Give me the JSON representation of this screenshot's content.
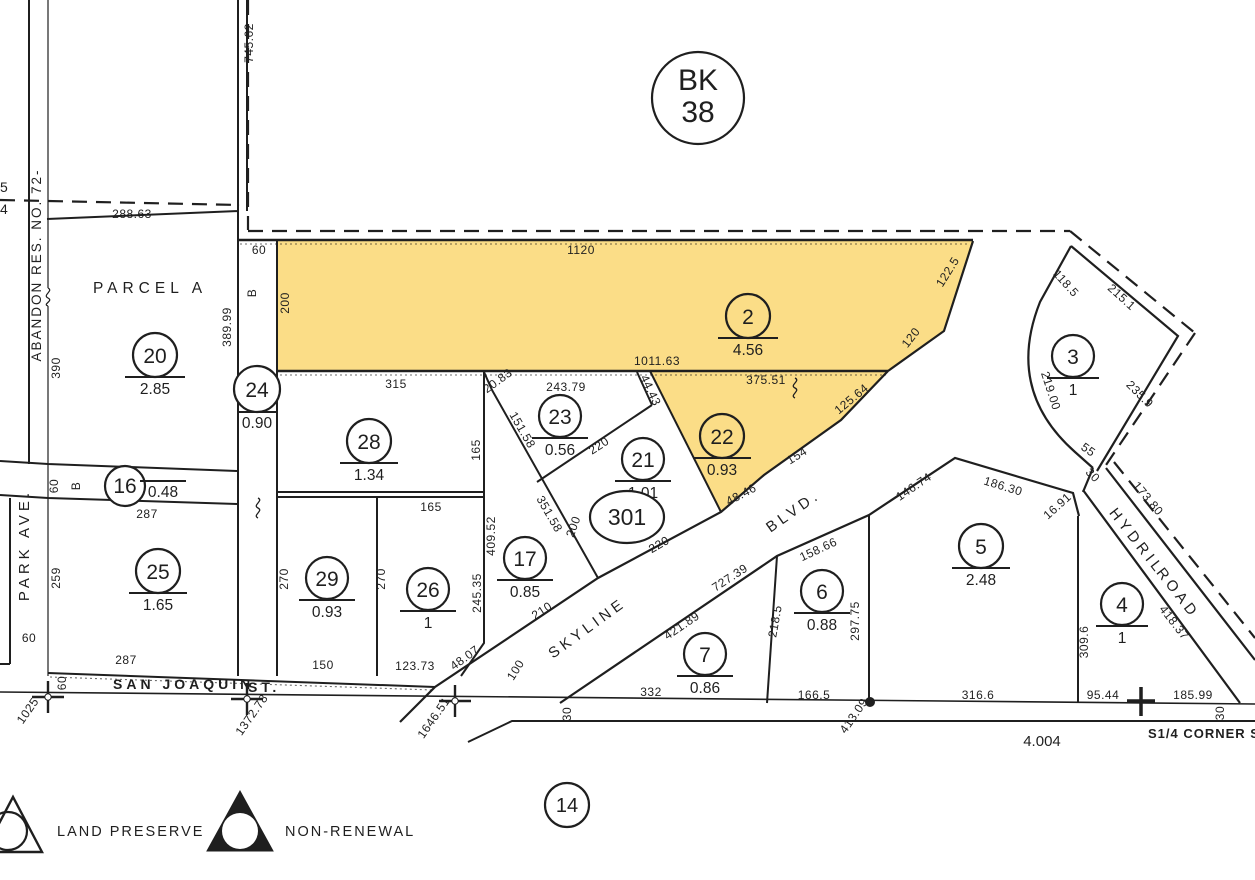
{
  "colors": {
    "highlight": "#FBDD87",
    "ink": "#1f1f1f"
  },
  "badges": {
    "book_line1": "BK",
    "book_line2": "38",
    "sheet": "14"
  },
  "streets": {
    "san_joaquin": "SAN JOAQUIN",
    "san_joaquin_suffix": "ST.",
    "park_ave": "PARK AVE.",
    "skyline": "SKYLINE",
    "skyline_suffix": "BLVD.",
    "hydril": "HYDRIL",
    "hydril_suffix": "ROAD"
  },
  "annotations": {
    "abandon_res": "ABANDON RES. NO. 72-",
    "parcel_a": "PARCEL A",
    "corner_label": "S1/4 CORNER SEC",
    "section_total": "4.004",
    "edge_fragment_top": "5",
    "edge_fragment_bottom": "4"
  },
  "legend": {
    "land_preserve": "LAND PRESERVE",
    "non_renewal": "NON-RENEWAL"
  },
  "parcels": {
    "p20": {
      "num": "20",
      "acres": "2.85"
    },
    "p24": {
      "num": "24",
      "acres": "0.90"
    },
    "p2": {
      "num": "2",
      "acres": "4.56"
    },
    "p3": {
      "num": "3",
      "acres": "1"
    },
    "p16": {
      "num": "16",
      "acres": "0.48"
    },
    "p23": {
      "num": "23",
      "acres": "0.56"
    },
    "p28": {
      "num": "28",
      "acres": "1.34"
    },
    "p21": {
      "num": "21",
      "acres": "1.01"
    },
    "p22": {
      "num": "22",
      "acres": "0.93"
    },
    "p301": {
      "num": "301"
    },
    "p17": {
      "num": "17",
      "acres": "0.85"
    },
    "p29": {
      "num": "29",
      "acres": "0.93"
    },
    "p26": {
      "num": "26",
      "acres": "1"
    },
    "p25": {
      "num": "25",
      "acres": "1.65"
    },
    "p5": {
      "num": "5",
      "acres": "2.48"
    },
    "p6": {
      "num": "6",
      "acres": "0.88"
    },
    "p7": {
      "num": "7",
      "acres": "0.86"
    },
    "p4": {
      "num": "4",
      "acres": "1"
    }
  },
  "dims": {
    "d745_62": "745.62",
    "d288_63": "288.63",
    "d1120": "1120",
    "d200": "200",
    "d1011_63": "1011.63",
    "d375_51": "375.51",
    "d122_5": "122.5",
    "d120": "120",
    "d125_64": "125.64",
    "d154": "154",
    "d48_46": "48.46",
    "d118_5": "118.5",
    "d215_1": "215.1",
    "d219_00": "219.00",
    "d235_9": "235.9",
    "d55": "55",
    "d30": "30",
    "d173_80": "173.80",
    "d186_30": "186.30",
    "d16_91": "16.91",
    "d146_74": "146.74",
    "d418_37": "418.37",
    "d309_6": "309.6",
    "d95_44": "95.44",
    "d185_99": "185.99",
    "d316_6": "316.6",
    "d297_75": "297.75",
    "d166_5": "166.5",
    "d158_66": "158.66",
    "d218_5": "218.5",
    "d727_39": "727.39",
    "d421_89": "421.89",
    "d332": "332",
    "d100": "100",
    "d1646_51": "1646.51",
    "d1372_78": "1372.78",
    "d1025": "1025",
    "d413_09": "413.09",
    "d243_79": "243.79",
    "d44_43": "44.43",
    "d20_83": "20.83",
    "d151_58": "151.58",
    "d351_58": "351.58",
    "d165": "165",
    "d220": "220",
    "d409_52": "409.52",
    "d245_35": "245.35",
    "d210": "210",
    "d315": "315",
    "d389_99": "389.99",
    "d390": "390",
    "d60": "60",
    "dB": "B",
    "d287": "287",
    "d259": "259",
    "d270": "270",
    "d150": "150",
    "d123_73": "123.73",
    "d48_07": "48.07"
  }
}
